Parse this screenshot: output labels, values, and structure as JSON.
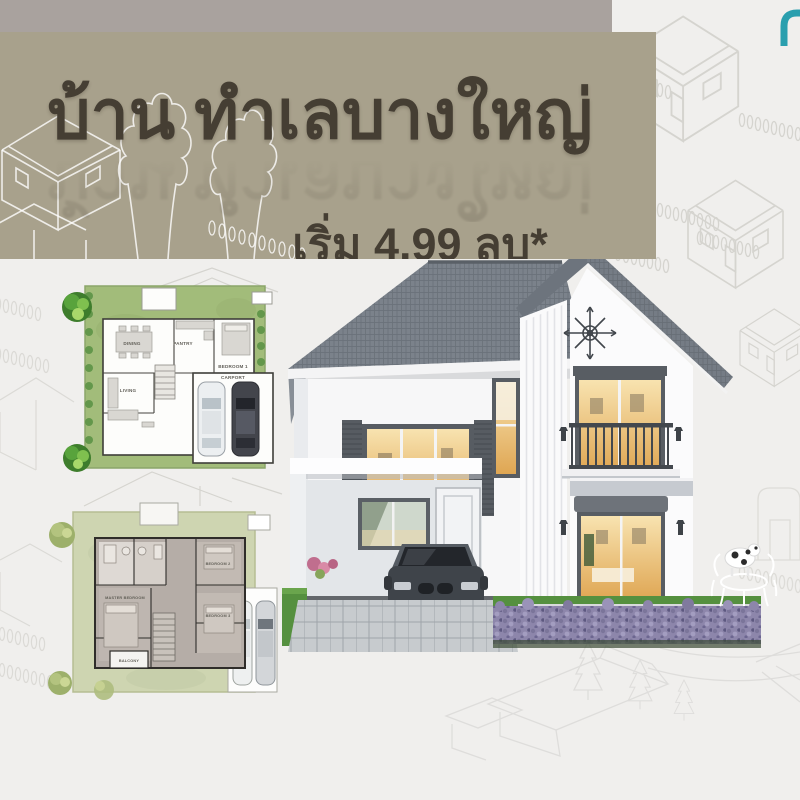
{
  "page": {
    "bg_color": "#f0efed"
  },
  "top_strip": {
    "color": "#a9a29e"
  },
  "banner": {
    "bg_color": "#a8a18c",
    "text_color": "#453e33",
    "title": "บ้าน ทำเลบางใหญ่",
    "price": "เริ่ม 4.99 ลบ*"
  },
  "logo": {
    "color": "#2a9fae"
  },
  "floorplan_first": {
    "lawn_color": "#a2bc7a",
    "rooms": {
      "dining": "DINING",
      "pantry": "PANTRY",
      "bedroom1": "BEDROOM 1",
      "living": "LIVING",
      "carport": "CARPORT"
    }
  },
  "floorplan_second": {
    "lawn_color": "#ced5b1",
    "rooms": {
      "master": "MASTER BEDROOM",
      "bedroom2": "BEDROOM 2",
      "bedroom3": "BEDROOM 3",
      "balcony": "BALCONY"
    }
  },
  "house": {
    "wall_color": "#fafafb",
    "roof_color": "#7b828b",
    "trim_color": "#575c62",
    "window_glow_color": "#e9bc6d",
    "lavender_color": "#8d86ab",
    "grass_color": "#55903f"
  }
}
